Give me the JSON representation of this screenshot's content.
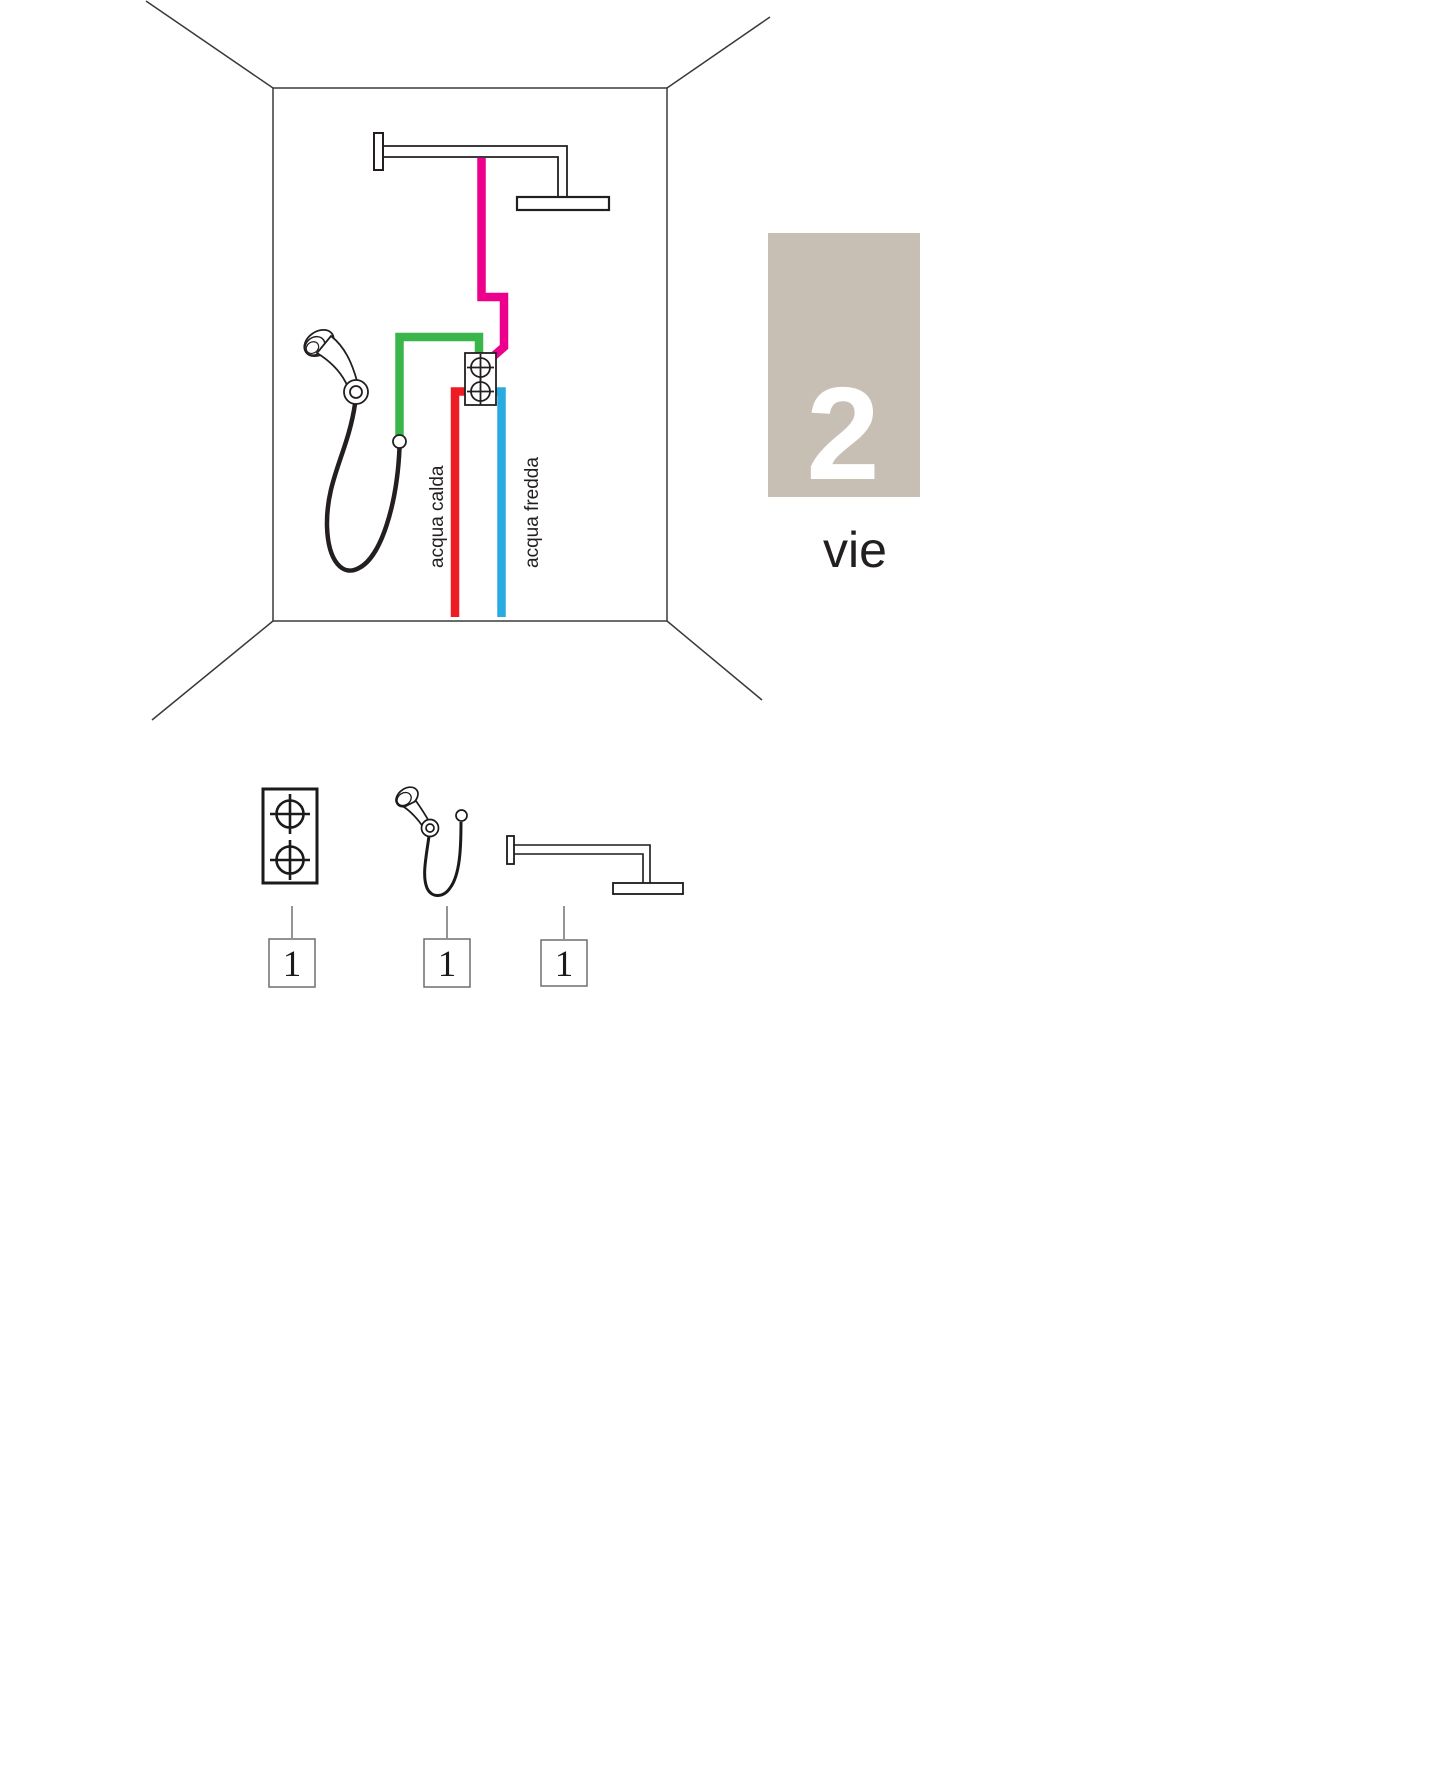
{
  "diagram": {
    "title_ways": {
      "number": "2",
      "unit": "vie"
    },
    "labels": {
      "hot_water": "acqua calda",
      "cold_water": "acqua fredda"
    },
    "colors": {
      "hot": "#ed1c24",
      "cold": "#29abe2",
      "head_feed": "#ec008c",
      "hand_feed": "#39b54a",
      "ways_box_bg": "#c8bfb4",
      "ways_number": "#ffffff",
      "outline": "#231f20"
    },
    "bom": [
      {
        "name": "built-in-mixer-2-way",
        "qty": "1"
      },
      {
        "name": "hand-shower-with-hose",
        "qty": "1"
      },
      {
        "name": "shower-arm-with-head",
        "qty": "1"
      }
    ]
  }
}
